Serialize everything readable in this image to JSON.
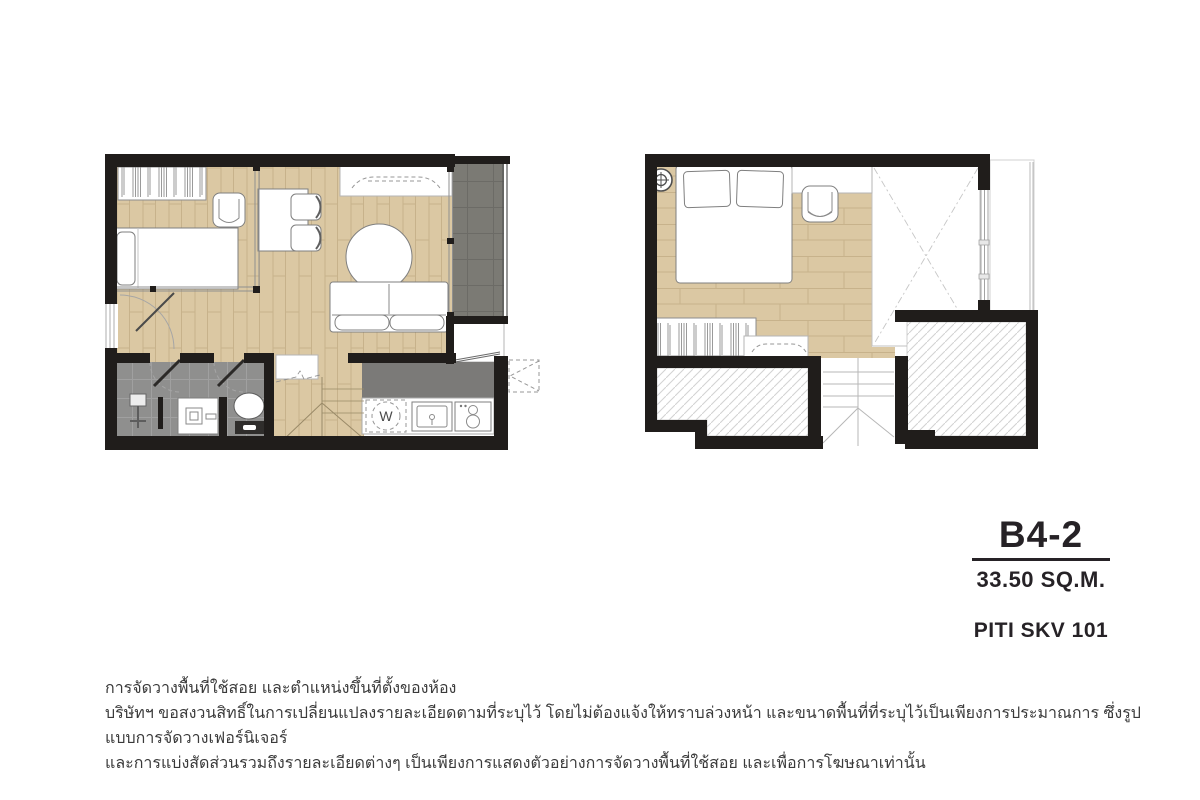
{
  "unit": {
    "model": "B4-2",
    "area": "33.50 SQ.M.",
    "project": "PITI SKV 101"
  },
  "plan_lower": {
    "washer_label": "W"
  },
  "disclaimer": {
    "line1": "การจัดวางพื้นที่ใช้สอย และตำแหน่งขึ้นที่ตั้งของห้อง",
    "line2": "บริษัทฯ ขอสงวนสิทธิ์ในการเปลี่ยนแปลงรายละเอียดตามที่ระบุไว้ โดยไม่ต้องแจ้งให้ทราบล่วงหน้า และขนาดพื้นที่ที่ระบุไว้เป็นเพียงการประมาณการ ซึ่งรูปแบบการจัดวางเฟอร์นิเจอร์",
    "line3": "และการแบ่งสัดส่วนรวมถึงรายละเอียดต่างๆ เป็นเพียงการแสดงตัวอย่างการจัดวางพื้นที่ใช้สอย และเพื่อการโฆษณาเท่านั้น"
  },
  "colors": {
    "wall": "#201d1b",
    "wood_floor": "#dbc8a3",
    "wood_line": "#c7b28b",
    "balcony_tile": "#7b7a74",
    "balcony_grout": "#6c6b66",
    "bath_tile": "#8f8f8e",
    "bath_grout": "#a0a0a0",
    "counter_dark": "#7b7a78",
    "hatch_line": "#d2d2d2",
    "text_dark": "#262226",
    "text_gray": "#3a3a3a"
  }
}
